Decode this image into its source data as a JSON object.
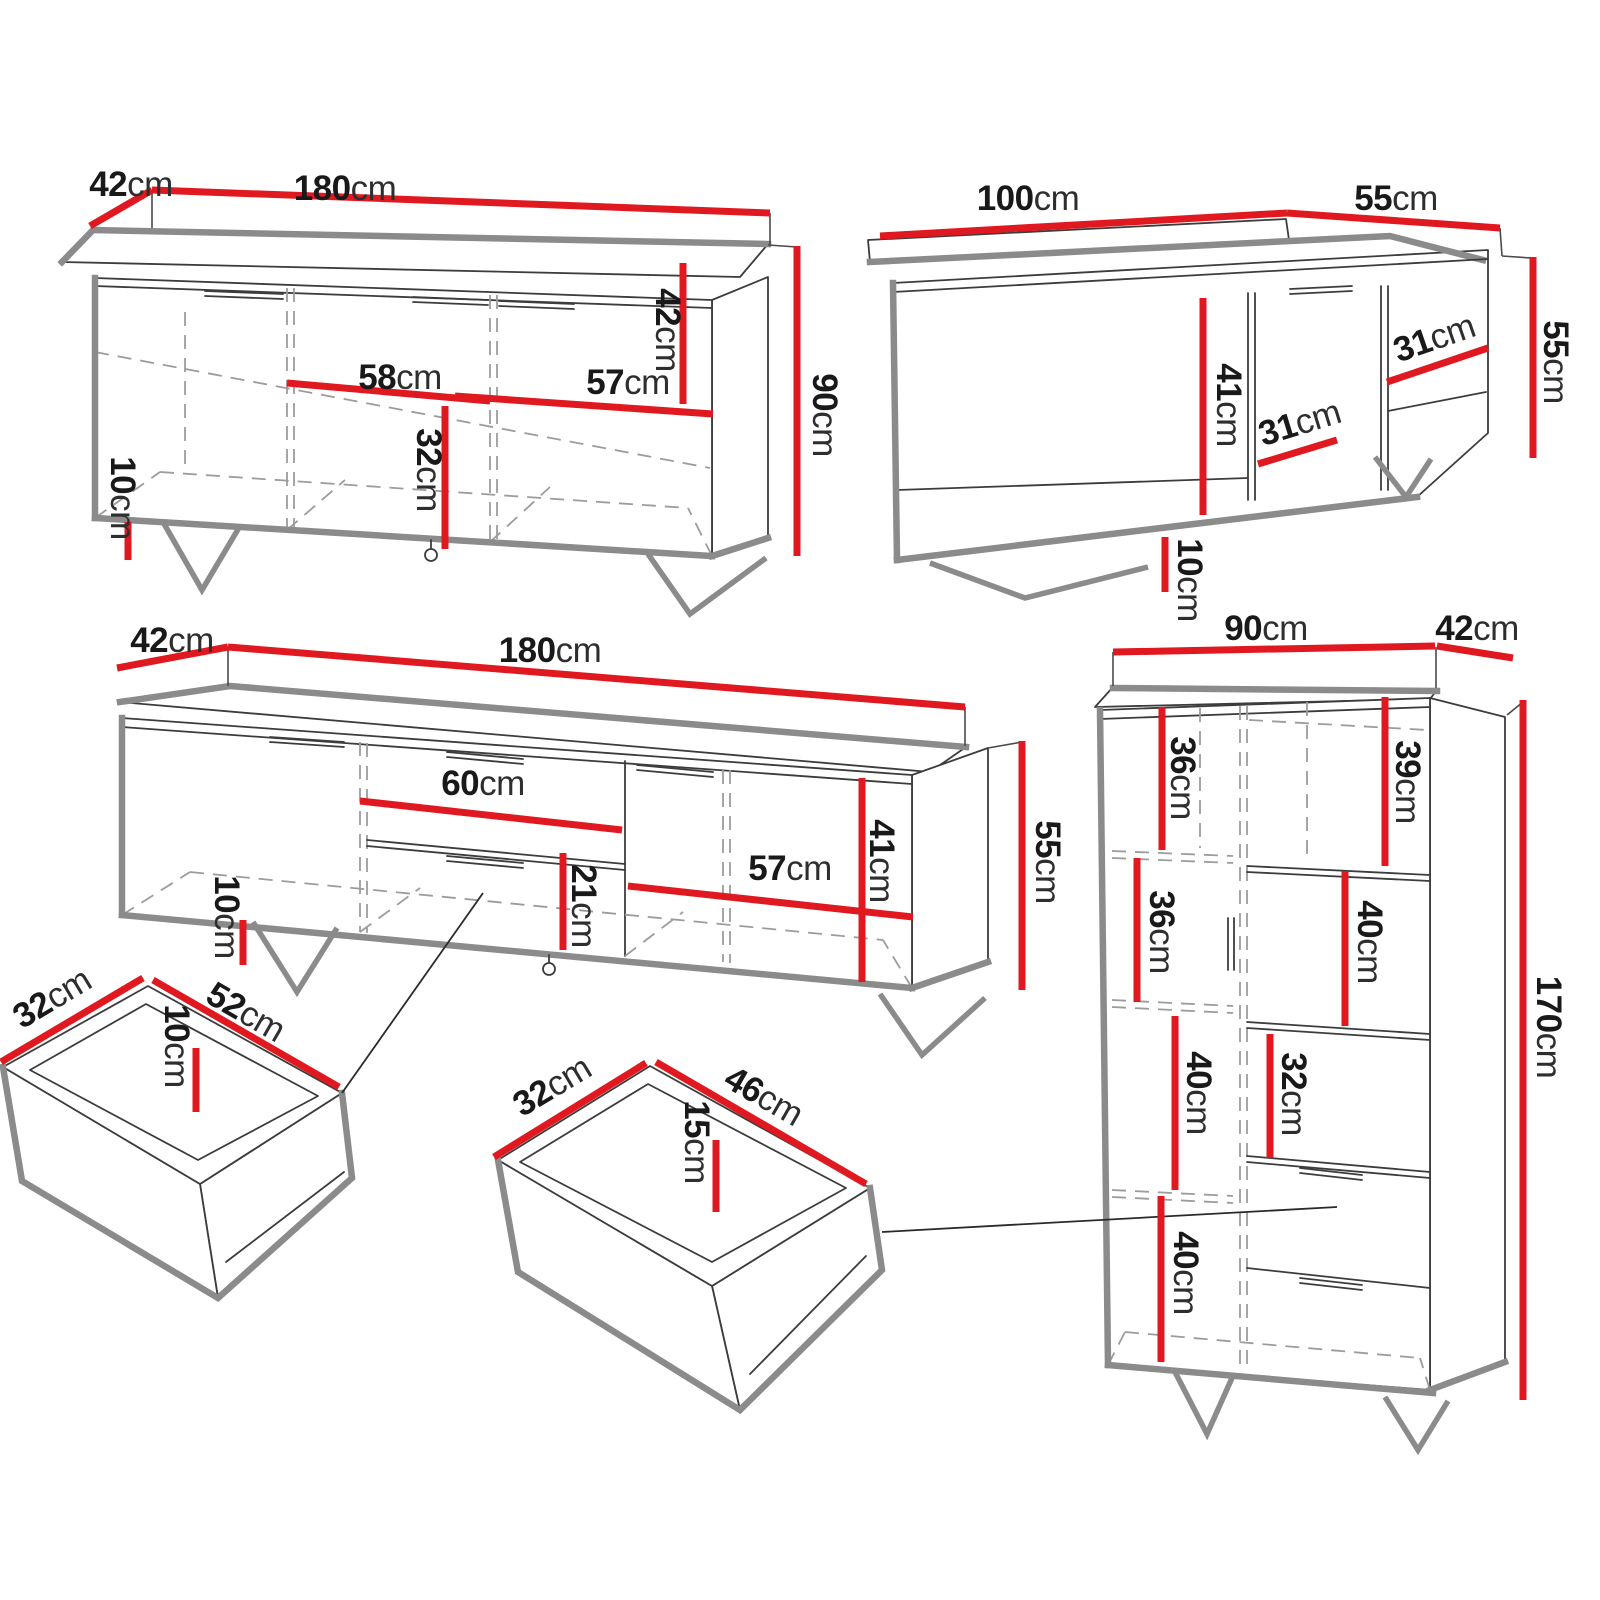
{
  "title": "Furniture set dimension diagram",
  "unit": "cm",
  "colors": {
    "dimension_red": "#e01920",
    "outline_gray": "#8b8b8b",
    "line_dark": "#3c3c3c",
    "dash_gray": "#9c9c9c",
    "text": "#191919",
    "background": "#ffffff"
  },
  "pieces": {
    "sideboard": {
      "name": "three-door sideboard",
      "labels": {
        "depth": {
          "num": "42",
          "unit": "cm"
        },
        "width": {
          "num": "180",
          "unit": "cm"
        },
        "height": {
          "num": "90",
          "unit": "cm"
        },
        "inner_height": {
          "num": "42",
          "unit": "cm"
        },
        "mid_width": {
          "num": "58",
          "unit": "cm"
        },
        "right_width": {
          "num": "57",
          "unit": "cm"
        },
        "lower_height": {
          "num": "32",
          "unit": "cm"
        },
        "leg": {
          "num": "10",
          "unit": "cm"
        }
      }
    },
    "coffee_table": {
      "name": "coffee table",
      "labels": {
        "width": {
          "num": "100",
          "unit": "cm"
        },
        "depth": {
          "num": "55",
          "unit": "cm"
        },
        "height": {
          "num": "55",
          "unit": "cm"
        },
        "inner_height": {
          "num": "41",
          "unit": "cm"
        },
        "right_width": {
          "num": "31",
          "unit": "cm"
        },
        "mid_width": {
          "num": "31",
          "unit": "cm"
        },
        "leg": {
          "num": "10",
          "unit": "cm"
        }
      }
    },
    "tv_stand": {
      "name": "TV stand",
      "labels": {
        "depth": {
          "num": "42",
          "unit": "cm"
        },
        "width": {
          "num": "180",
          "unit": "cm"
        },
        "height": {
          "num": "55",
          "unit": "cm"
        },
        "drawer_width": {
          "num": "60",
          "unit": "cm"
        },
        "drawer_height": {
          "num": "21",
          "unit": "cm"
        },
        "inner_height": {
          "num": "41",
          "unit": "cm"
        },
        "door_width": {
          "num": "57",
          "unit": "cm"
        },
        "leg": {
          "num": "10",
          "unit": "cm"
        }
      }
    },
    "drawer_small": {
      "name": "drawer insert 52",
      "labels": {
        "depth": {
          "num": "32",
          "unit": "cm"
        },
        "width": {
          "num": "52",
          "unit": "cm"
        },
        "height": {
          "num": "10",
          "unit": "cm"
        }
      }
    },
    "drawer_medium": {
      "name": "drawer insert 46",
      "labels": {
        "depth": {
          "num": "32",
          "unit": "cm"
        },
        "width": {
          "num": "46",
          "unit": "cm"
        },
        "height": {
          "num": "15",
          "unit": "cm"
        }
      }
    },
    "cabinet": {
      "name": "highboard cabinet",
      "labels": {
        "width": {
          "num": "90",
          "unit": "cm"
        },
        "depth": {
          "num": "42",
          "unit": "cm"
        },
        "height": {
          "num": "170",
          "unit": "cm"
        },
        "shelf_top_left": {
          "num": "36",
          "unit": "cm"
        },
        "shelf_top_right": {
          "num": "39",
          "unit": "cm"
        },
        "shelf_mid_left": {
          "num": "36",
          "unit": "cm"
        },
        "shelf_mid_right": {
          "num": "40",
          "unit": "cm"
        },
        "shelf_lower_left": {
          "num": "40",
          "unit": "cm"
        },
        "shelf_lower_right": {
          "num": "32",
          "unit": "cm"
        },
        "shelf_bottom_left": {
          "num": "40",
          "unit": "cm"
        }
      }
    }
  }
}
